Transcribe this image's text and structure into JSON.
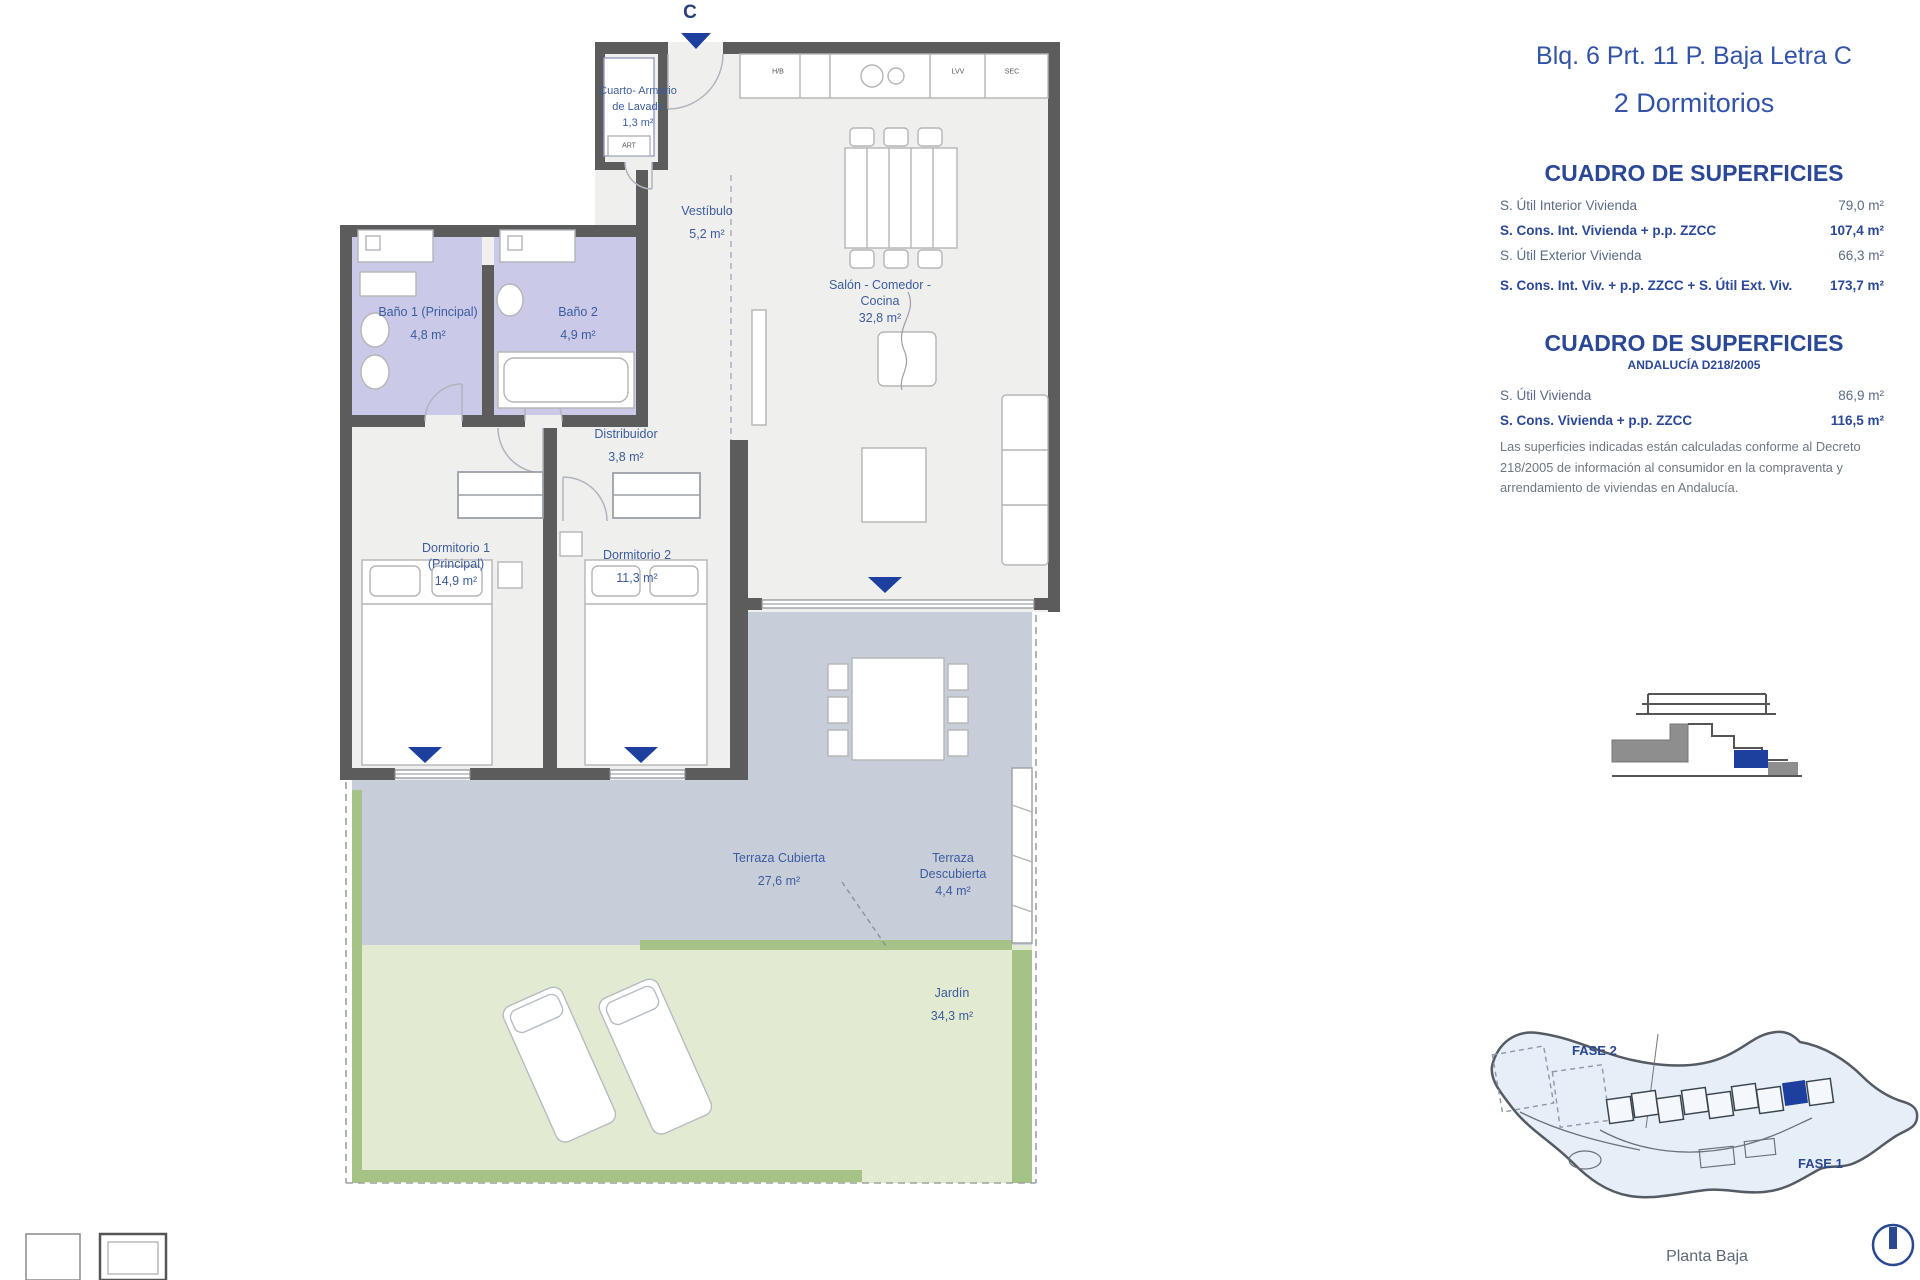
{
  "plan": {
    "letter": "C"
  },
  "rooms": {
    "laundry": {
      "lines": [
        "Cuarto- Armario",
        "de Lavado",
        "1,3 m²"
      ]
    },
    "vestibulo": {
      "lines": [
        "Vestíbulo",
        "5,2 m²"
      ]
    },
    "salon": {
      "lines": [
        "Salón - Comedor -",
        "Cocina",
        "32,8 m²"
      ]
    },
    "bano1": {
      "lines": [
        "Baño 1 (Principal)",
        "4,8 m²"
      ]
    },
    "bano2": {
      "lines": [
        "Baño 2",
        "4,9 m²"
      ]
    },
    "distribuidor": {
      "lines": [
        "Distribuidor",
        "3,8 m²"
      ]
    },
    "dormitorio1": {
      "lines": [
        "Dormitorio 1",
        "(Principal)",
        "14,9 m²"
      ]
    },
    "dormitorio2": {
      "lines": [
        "Dormitorio 2",
        "11,3 m²"
      ]
    },
    "terraza_cubierta": {
      "lines": [
        "Terraza Cubierta",
        "27,6 m²"
      ]
    },
    "terraza_descubierta": {
      "lines": [
        "Terraza",
        "Descubierta",
        "4,4 m²"
      ]
    },
    "jardin": {
      "lines": [
        "Jardín",
        "34,3 m²"
      ]
    }
  },
  "appliances": {
    "hb": "H/B",
    "lvv": "LVV",
    "sec": "SEC",
    "art": "ART"
  },
  "panel": {
    "title": "Blq. 6 Prt. 11 P. Baja Letra C",
    "subtitle": "2 Dormitorios",
    "table1": {
      "heading": "CUADRO DE SUPERFICIES",
      "rows": [
        {
          "label": "S. Útil Interior Vivienda",
          "value": "79,0 m²"
        },
        {
          "label": "S. Cons. Int. Vivienda + p.p. ZZCC",
          "value": "107,4 m²"
        },
        {
          "label": "S. Útil Exterior Vivienda",
          "value": "66,3 m²"
        },
        {
          "label": "S. Cons. Int. Viv. + p.p. ZZCC + S. Útil Ext. Viv.",
          "value": "173,7 m²"
        }
      ]
    },
    "table2": {
      "heading": "CUADRO DE SUPERFICIES",
      "subheading": "ANDALUCÍA D218/2005",
      "rows": [
        {
          "label": "S. Útil Vivienda",
          "value": "86,9 m²"
        },
        {
          "label": "S. Cons. Vivienda + p.p. ZZCC",
          "value": "116,5 m²"
        }
      ],
      "note": "Las superficies indicadas están calculadas conforme al Decreto 218/2005 de información al consumidor en la compraventa y arrendamiento de viviendas en Andalucía."
    }
  },
  "site": {
    "fase1": "FASE 1",
    "fase2": "FASE 2",
    "caption": "Planta Baja"
  },
  "colors": {
    "accent_navy": "#1d3f9e",
    "label_blue": "#3c5c9e",
    "wall_gray": "#5c5c5c",
    "bath_lavender": "#cacae8",
    "terrace_blue_gray": "#c8cdda",
    "garden_green": "#e2ebd1",
    "hedge_green": "#a5c287",
    "site_fill": "#e6eef8"
  }
}
